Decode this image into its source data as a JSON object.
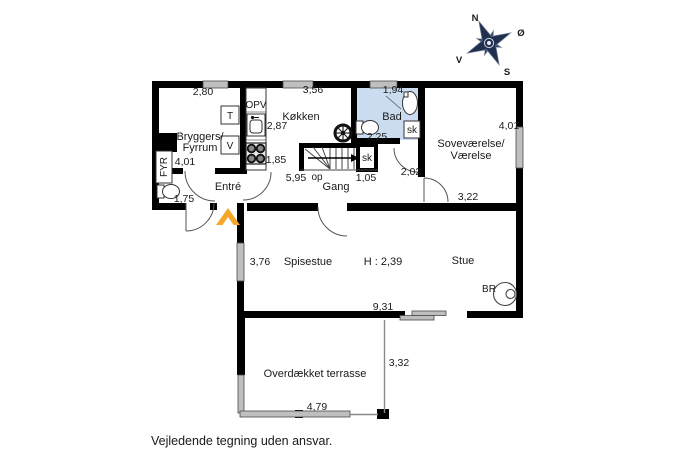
{
  "note": "Vejledende tegning uden ansvar.",
  "compass": {
    "n": "N",
    "e": "Ø",
    "s": "S",
    "w": "V"
  },
  "rooms": {
    "bryggers1": "Bryggers/",
    "bryggers2": "Fyrrum",
    "entre": "Entré",
    "kokken": "Køkken",
    "bad": "Bad",
    "sov1": "Soveværelse/",
    "sov2": "Værelse",
    "gang": "Gang",
    "spisestue": "Spisestue",
    "stue": "Stue",
    "terrasse": "Overdækket terrasse"
  },
  "dims": {
    "bryggers_top": "2,80",
    "kokken_top": "3,56",
    "bad_top": "1,94",
    "sov_right": "4,01",
    "sov_width": "3,22",
    "sov_door": "2,02",
    "bryggers_left": "4,01",
    "entre_w": "1,75",
    "sink": "2,87",
    "stove": "1,85",
    "gang_l": "5,95",
    "sk_w": "1,05",
    "bad_inner": "2,25",
    "spise_left": "3,76",
    "ceiling": "H : 2,39",
    "stue_w": "9,31",
    "terr_d": "3,32",
    "terr_w": "4,79"
  },
  "fix": {
    "opv": "OPV",
    "t": "T",
    "v": "V",
    "fyr": "FYR",
    "sk": "sk",
    "op": "op",
    "br": "BR"
  },
  "colors": {
    "wall": "#000000",
    "window": "#bfbfbf",
    "bathroom_fill": "#cbdcf0",
    "entrance_marker": "#f5a72b",
    "compass": "#20304f"
  }
}
